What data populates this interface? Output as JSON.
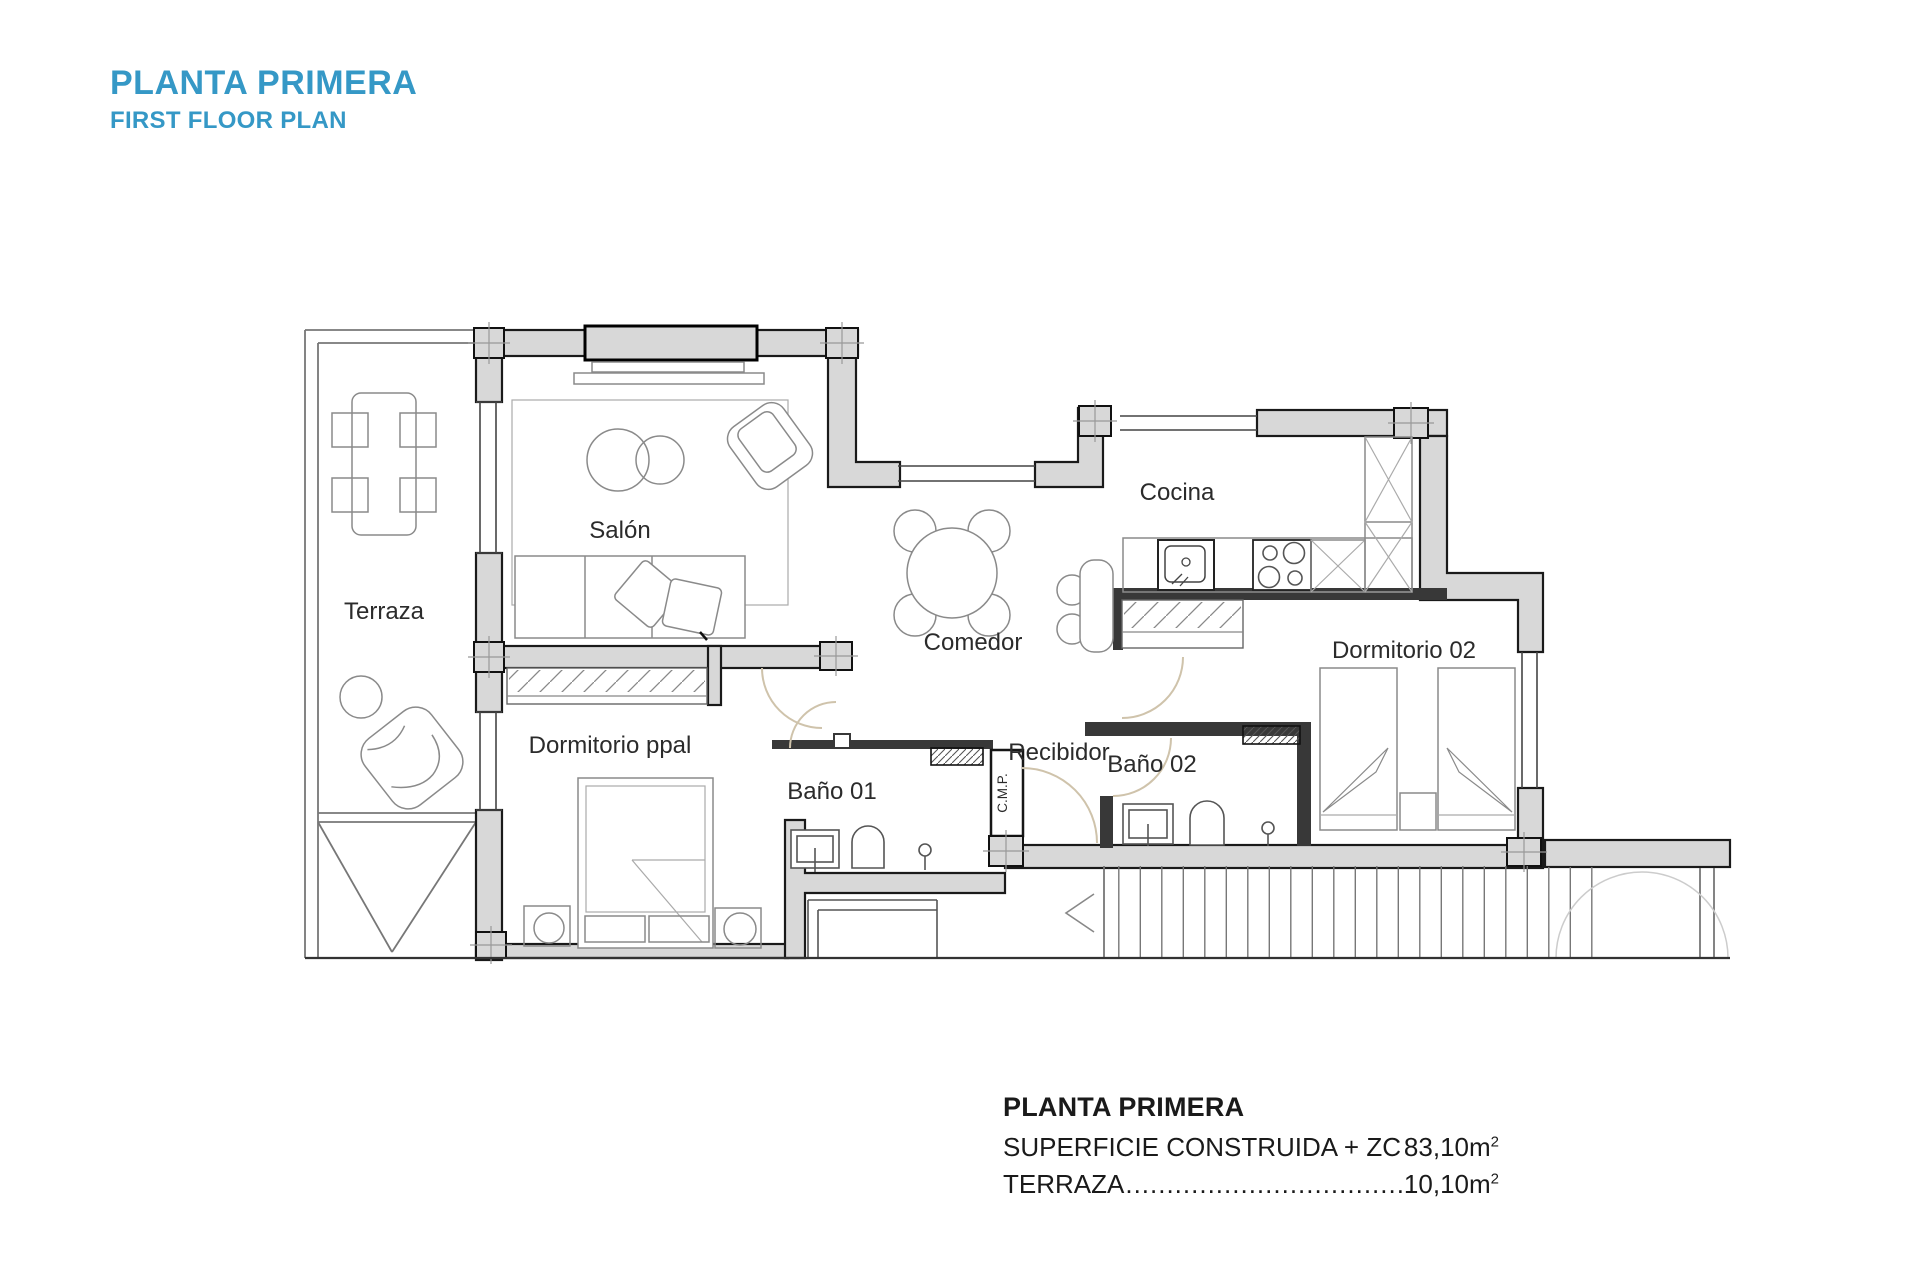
{
  "header": {
    "title": "PLANTA PRIMERA",
    "subtitle": "FIRST FLOOR PLAN"
  },
  "plan": {
    "rooms": {
      "terraza": "Terraza",
      "salon": "Salón",
      "comedor": "Comedor",
      "cocina": "Cocina",
      "dormitorio02": "Dormitorio 02",
      "dormitorio_ppal": "Dormitorio ppal",
      "bano01": "Baño 01",
      "recibidor": "Recibidor",
      "bano02": "Baño 02",
      "cmp": "C.M.P."
    }
  },
  "summary": {
    "title": "PLANTA PRIMERA",
    "rows": [
      {
        "label": "SUPERFICIE CONSTRUIDA + ZC",
        "leader": "........................................................................",
        "value": "83,10m",
        "sup": "2"
      },
      {
        "label": "TERRAZA",
        "leader": "........................................................................................................",
        "value": "10,10m",
        "sup": "2"
      }
    ]
  },
  "colors": {
    "accent": "#3598C6",
    "wall_fill": "#D8D8D8"
  }
}
